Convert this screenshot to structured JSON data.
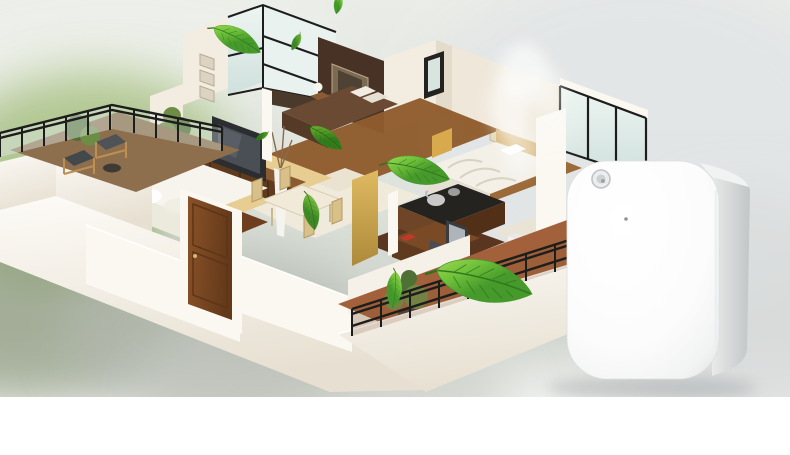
{
  "scene": {
    "kind": "product-showcase-render",
    "elements": [
      "blurred-garden-background",
      "isometric-apartment-cutaway",
      "floating-green-leaves",
      "aroma-mist",
      "wall-mounted-scent-diffuser"
    ],
    "leaves_count": 9
  },
  "house": {
    "rooms": [
      "terrace-balcony",
      "living-room",
      "corner-window-lounge",
      "master-bedroom",
      "guest-bedroom",
      "kitchen",
      "dining-area",
      "entry-door",
      "home-office",
      "laundry-area",
      "lower-balcony"
    ]
  },
  "device": {
    "type": "scent-diffuser",
    "features": [
      "light-sensor",
      "pinhole-indicator"
    ]
  },
  "colors": {
    "bg_top": "#eaede7",
    "bg_green": "#a8c183",
    "bg_moss": "#8fb068",
    "bg_gray_green": "#9aa58c",
    "bg_gray": "#b4b9b0",
    "bg_right": "#e3e6e7",
    "bg_bottom": "#ffffff",
    "wall_bright": "#fbf8f2",
    "wall_lit": "#f2ece1",
    "wall_shade": "#e4dccb",
    "wall_band": "#efe8da",
    "floor_wood": "#8f5c2d",
    "floor_wood_dark": "#5a3520",
    "carpet": "#e8cd92",
    "tile": "#f0eadb",
    "terracotta": "#a2613a",
    "terrace_floor": "#8d6f4e",
    "accent_wall": "#483225",
    "art_frame": "#7d6a52",
    "door_wood": "#8a5228",
    "door_wood_dark": "#63391a",
    "glass_light": "#eef5f2",
    "glass_dark": "#cfe0dc",
    "frame_black": "#1d1d1b",
    "sofa": "#f7f4ee",
    "bed_master": "#6b4a33",
    "bed_guest": "#f3f0e8",
    "headboard": "#d9b678",
    "counter": "#24231f",
    "cabinet_wood": "#6e4526",
    "gold_panel": "#cfa94e",
    "desk_wood": "#7a4a26",
    "chair_gray": "#4a4d52",
    "dining_chair": "#d8c08a",
    "plant_green": "#6d8c46",
    "plant_dark": "#4f7034",
    "leaf_light": "#a8de58",
    "leaf_mid": "#6fc03a",
    "leaf_dark": "#46992b",
    "leaf_vein": "#2f7a1e",
    "leaf_stem": "#35701d",
    "mist": "#ffffff",
    "device_front": "#ffffff",
    "device_edge": "#e2e4e5",
    "device_side": "#c2c6c7",
    "device_side_light": "#e8eaea",
    "sensor_ring": "#bfc3c5",
    "sensor_fill": "#eceeee",
    "sensor_dot": "#9fa4a6",
    "device_shadow": "#a7abac"
  }
}
